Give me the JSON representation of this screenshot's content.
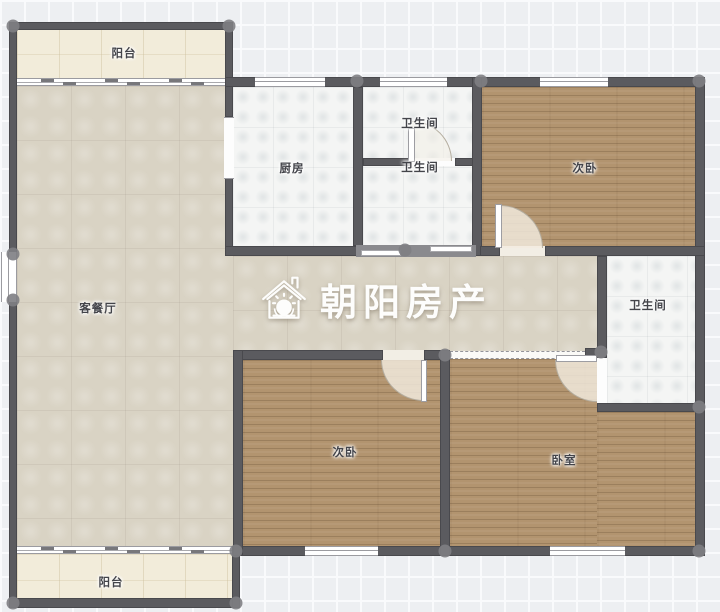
{
  "watermark": {
    "brand_name": "朝阳房产",
    "icon": "house-sun-icon"
  },
  "rooms": {
    "balcony_top": {
      "label": "阳台",
      "floor": "tile-cream"
    },
    "kitchen": {
      "label": "厨房",
      "floor": "tile-white"
    },
    "bathroom_top": {
      "label": "卫生间",
      "floor": "tile-white"
    },
    "bathroom_mid": {
      "label": "卫生间",
      "floor": "tile-white"
    },
    "bedroom_top_right": {
      "label": "次卧",
      "floor": "wood"
    },
    "living_dining": {
      "label": "客餐厅",
      "floor": "tile-beige"
    },
    "bathroom_right": {
      "label": "卫生间",
      "floor": "tile-white"
    },
    "bedroom_bottom_middle": {
      "label": "次卧",
      "floor": "wood"
    },
    "bedroom_bottom_right": {
      "label": "卧室",
      "floor": "wood"
    },
    "balcony_bottom": {
      "label": "阳台",
      "floor": "tile-cream"
    }
  },
  "colors": {
    "wall": "#5b5b5f",
    "floor_wood": "#b2946f",
    "floor_beige": "#d9d3c4",
    "floor_cream": "#f2ecda",
    "floor_white_tile": "#f4f5f4",
    "background": "#edeff2",
    "watermark_text": "#fdfdfc"
  }
}
